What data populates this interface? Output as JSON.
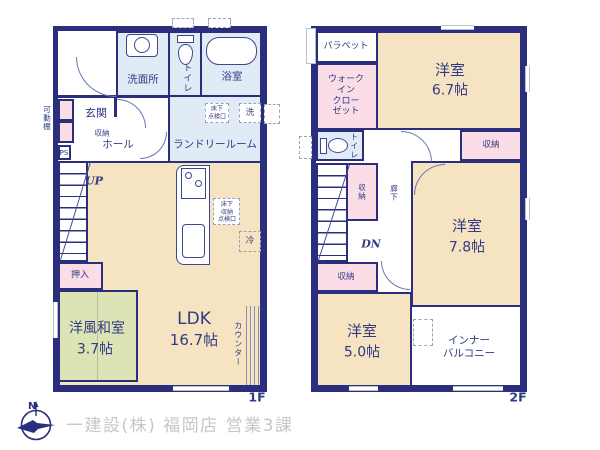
{
  "meta": {
    "type": "japanese-house-floor-plan"
  },
  "colors": {
    "wall": "#2a2e7c",
    "room_beige": "#f6e3c1",
    "room_pink": "#fadde6",
    "room_green": "#dce4b5",
    "room_blue": "#e1ebf5",
    "footer_gray": "#c6c6cc"
  },
  "footer": {
    "company": "一建設(株) 福岡店 営業3課",
    "compass": "north-compass"
  },
  "floor1": {
    "floor_label": "1F",
    "washroom": "洗面所",
    "toilet": "トイレ",
    "bath": "浴室",
    "entrance": "玄関",
    "entrance_storage": "収納",
    "movable_shelf": "可動棚",
    "ps": "PS",
    "hall": "ホール",
    "laundry": "ランドリールーム",
    "underfloor_hatch": "床下\n点検口",
    "washer": "洗",
    "up": "UP",
    "oshiire": "押入",
    "tatami_name": "洋風和室",
    "tatami_size": "3.7帖",
    "ldk_name": "LDK",
    "ldk_size": "16.7帖",
    "underfloor_storage": "床下\n収納\n点検口",
    "fridge": "冷",
    "counter": "カウンター"
  },
  "floor2": {
    "floor_label": "2F",
    "parapet": "パラペット",
    "walk_in_closet": "ウォーク\nイン\nクロー\nゼット",
    "bedroom_a_name": "洋室",
    "bedroom_a_size": "6.7帖",
    "toilet": "トイレ",
    "storage_a": "収納",
    "storage_b": "収納",
    "hallway": "廊下",
    "dn": "DN",
    "bedroom_b_name": "洋室",
    "bedroom_b_size": "7.8帖",
    "storage_c": "収納",
    "bedroom_c_name": "洋室",
    "bedroom_c_size": "5.0帖",
    "inner_balcony": "インナー\nバルコニー"
  }
}
